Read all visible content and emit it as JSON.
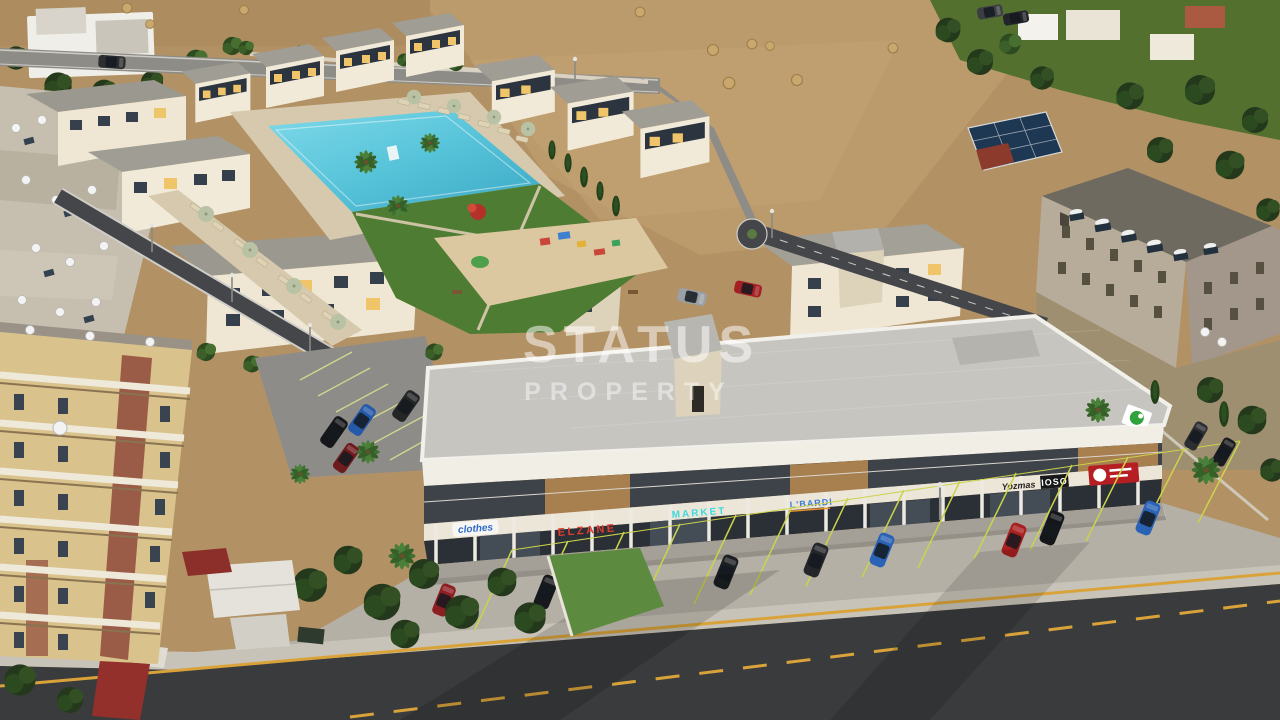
{
  "watermark": {
    "line1": "STATUS",
    "line2": "PROPERTY"
  },
  "commercial": {
    "signs": [
      {
        "id": "clothes",
        "label": "clothes",
        "color": "#2e6bc8",
        "bg": "#ffffff"
      },
      {
        "id": "elzane",
        "label": "ELZANE",
        "color": "#e23d30"
      },
      {
        "id": "market",
        "label": "MARKET",
        "color": "#3fd8de"
      },
      {
        "id": "lbardi",
        "label": "L'BARDI",
        "color": "#3a79d8"
      },
      {
        "id": "yozmas",
        "label": "Yozmas",
        "color": "#26221e"
      },
      {
        "id": "ioso",
        "label": "IOSO",
        "color": "#ffffff",
        "bg": "#17181a"
      },
      {
        "id": "cafe",
        "label": "",
        "color": "#ffffff",
        "bg": "#b51f23"
      }
    ],
    "roof_logo_color": "#2fa23b"
  },
  "palette": {
    "field": "#b29165",
    "pool": "#58c4da",
    "lawn": "#4f7c33",
    "asphalt": "#3a3b3d",
    "road_marking_yellow": "#d9a33a",
    "parking_line": "#cbd34a",
    "new_building_wall": "#f2ead8",
    "old_building_wall": "#d9c28c",
    "watermark": "#ffffff"
  }
}
